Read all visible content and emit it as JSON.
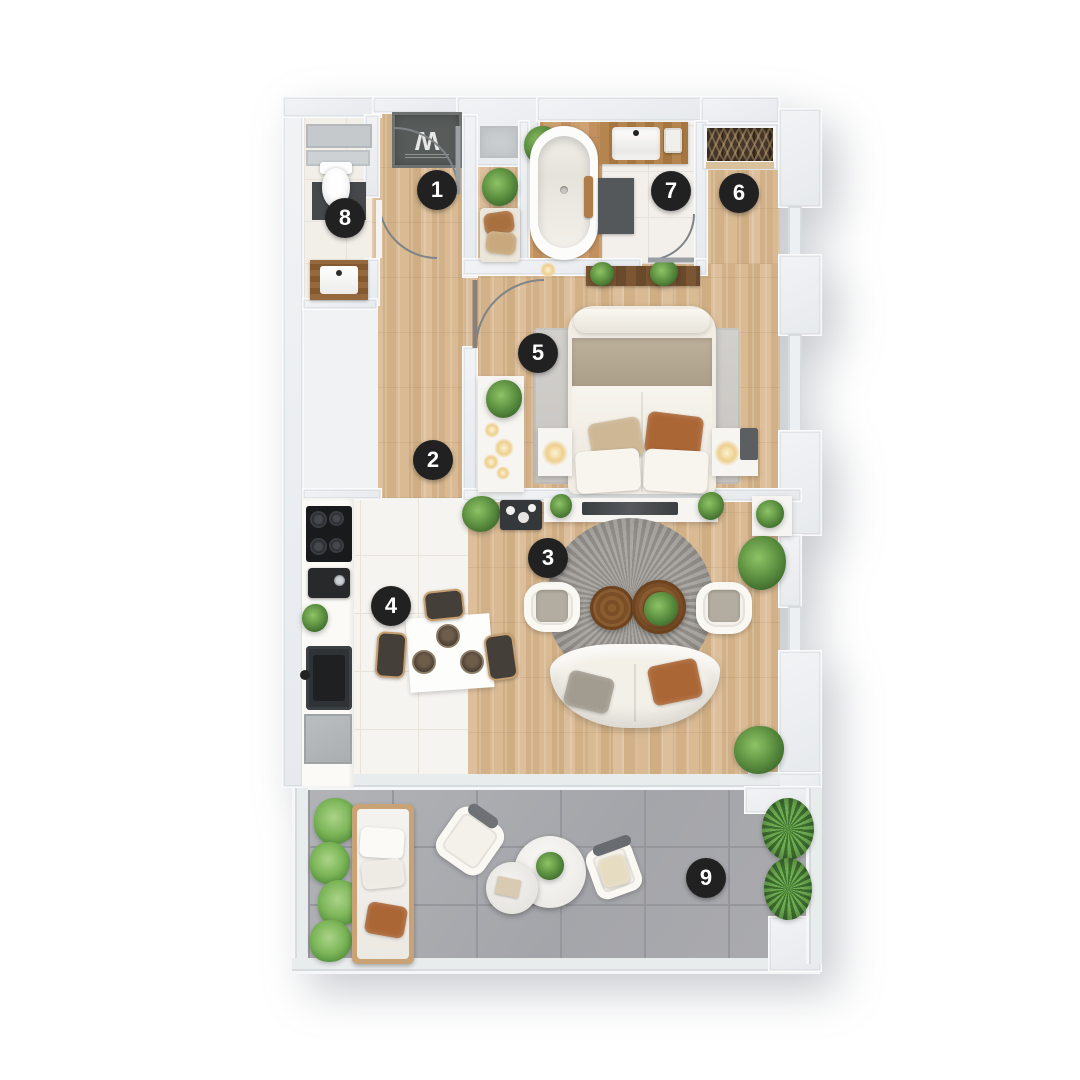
{
  "markers": [
    {
      "label": "1",
      "x": 437,
      "y": 190
    },
    {
      "label": "2",
      "x": 433,
      "y": 460
    },
    {
      "label": "3",
      "x": 548,
      "y": 558
    },
    {
      "label": "4",
      "x": 391,
      "y": 606
    },
    {
      "label": "5",
      "x": 538,
      "y": 353
    },
    {
      "label": "6",
      "x": 739,
      "y": 193
    },
    {
      "label": "7",
      "x": 671,
      "y": 191
    },
    {
      "label": "8",
      "x": 345,
      "y": 218
    },
    {
      "label": "9",
      "x": 706,
      "y": 878
    }
  ],
  "doormat": {
    "monogram": "W"
  },
  "palette": {
    "marker_bg": "#212121",
    "marker_fg": "#ffffff",
    "wood": "#d6b68f",
    "tile": "#f6f4f0",
    "balcony_tile": "#a8a9ad",
    "wall": "#eaedf0",
    "plant_green": "#5f9342",
    "pillow_rust": "#ab6636",
    "sofa_cream": "#f3f0e8",
    "mat_dark": "#45494c"
  }
}
